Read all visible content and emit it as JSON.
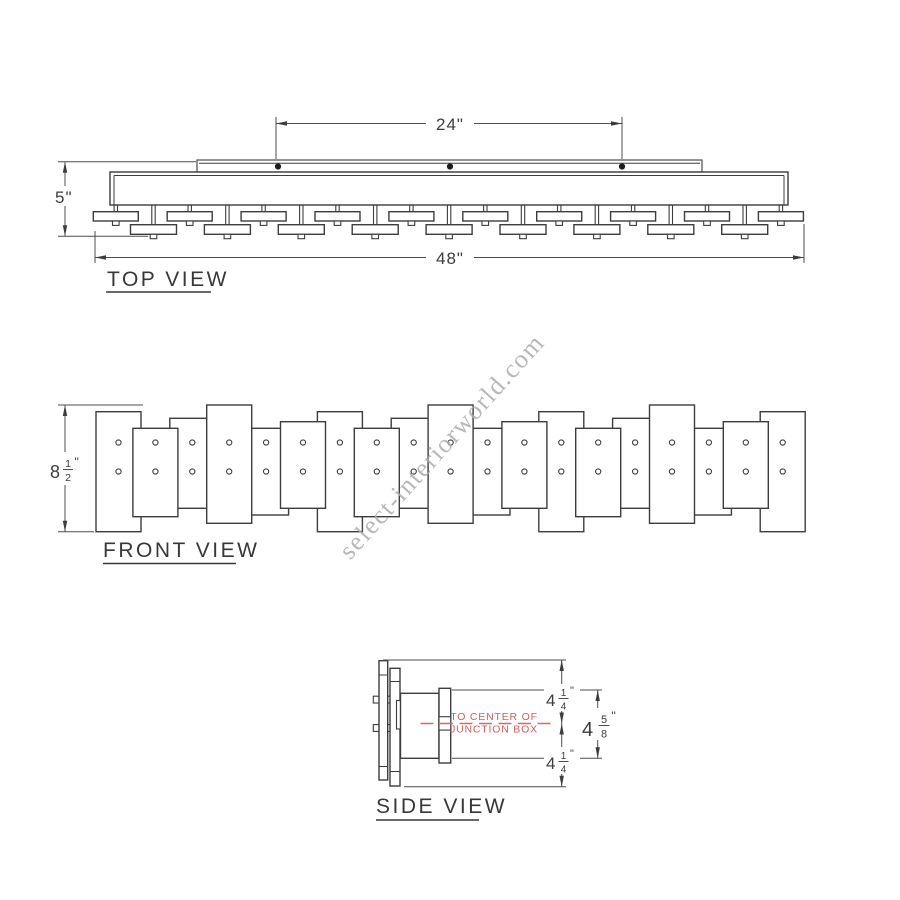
{
  "watermark": {
    "text": "select-interiorworld.com"
  },
  "units": {
    "inch": "\""
  },
  "top_view": {
    "label": "TOP VIEW",
    "dim_canopy_width": "24\"",
    "dim_height": "5\"",
    "dim_total_width": "48\""
  },
  "front_view": {
    "label": "FRONT VIEW",
    "dim_height": {
      "whole": "8",
      "num": "1",
      "den": "2"
    }
  },
  "side_view": {
    "label": "SIDE VIEW",
    "note": {
      "line1": "TO CENTER OF",
      "line2": "JUNCTION BOX"
    },
    "dim_upper": {
      "whole": "4",
      "num": "1",
      "den": "4"
    },
    "dim_lower": {
      "whole": "4",
      "num": "1",
      "den": "4"
    },
    "dim_overall": {
      "whole": "4",
      "num": "5",
      "den": "8"
    }
  },
  "colors": {
    "line": "#3d3d3d",
    "red": "#cf6060",
    "red_line": "#e06565",
    "watermark": "#acacac"
  }
}
